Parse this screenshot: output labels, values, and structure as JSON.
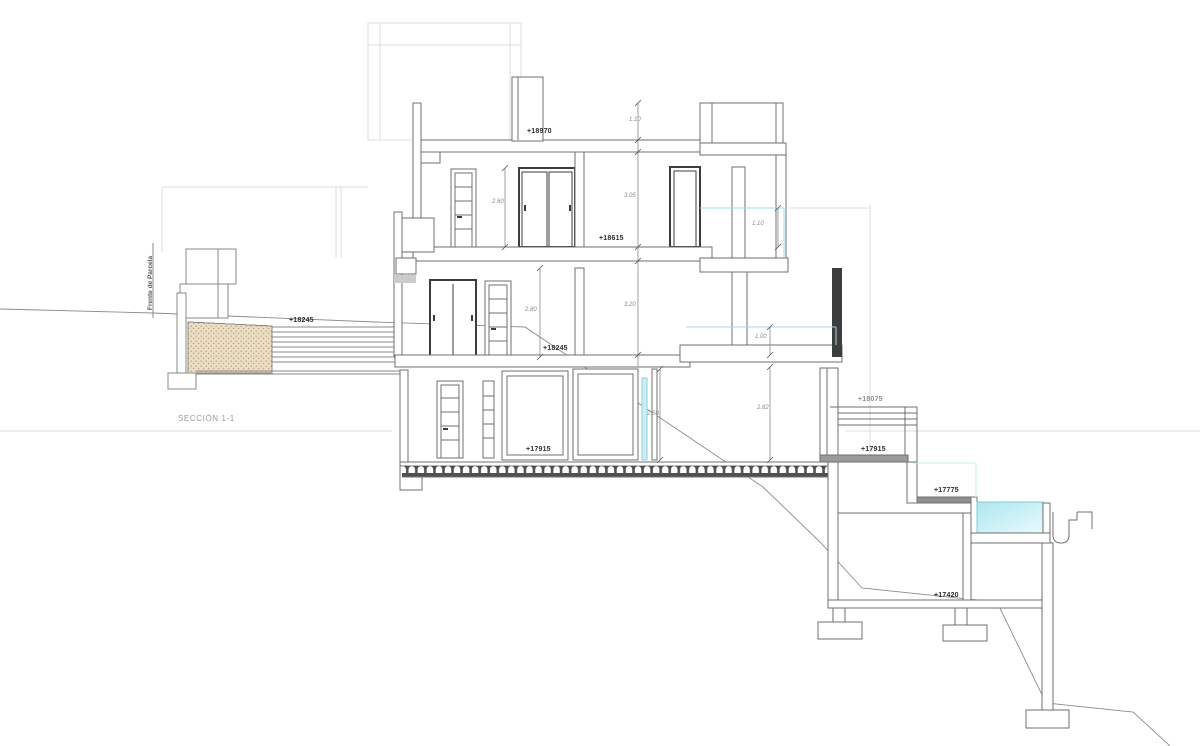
{
  "titles": {
    "section": "SECCIÓN 1-1",
    "parcel_front": "Frente de Parcela"
  },
  "levels": {
    "roof": "+18970",
    "floor3": "+18615",
    "floor2": "+18245",
    "floor2_left": "+18245",
    "stair_landing": "+18075",
    "floor1": "+17915",
    "floor1_right": "+17915",
    "pool_deck": "+17775",
    "basement": "+17420"
  },
  "dims": {
    "roof_parapet": "1.10",
    "l3_opening": "2.60",
    "l3_height": "3.05",
    "l2_opening": "2.80",
    "l2_height": "3.20",
    "l3_railing": "1.10",
    "l2_railing": "1.00",
    "l1_left_height": "2.50",
    "l1_right_height": "2.82"
  },
  "colors": {
    "line": "#6f6f6f",
    "faint_line": "#dedede",
    "terrain": "#8c8c8c",
    "glass_cyan": "#9fdbe6",
    "pool_water_dark": "#aee6f0",
    "pool_water_light": "#e8fafc",
    "hatch_fill": "#ecdec4",
    "hatch_dot": "#b39b72",
    "dark_frame": "#3d3d3d"
  }
}
